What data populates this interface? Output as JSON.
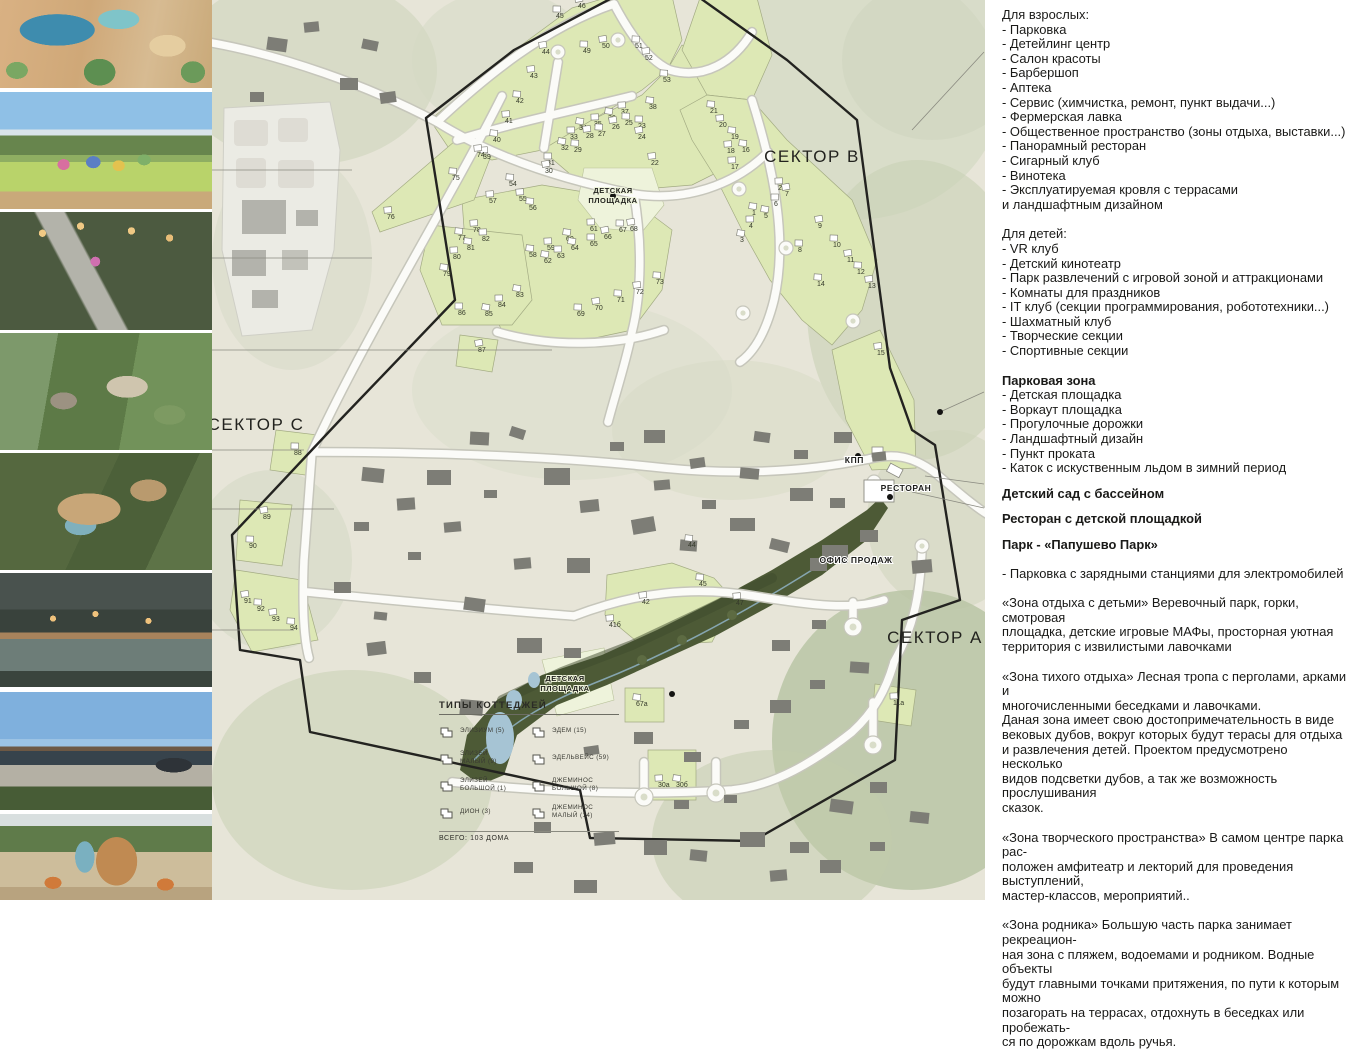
{
  "photos": [
    {
      "name": "waterpark-aerial-render"
    },
    {
      "name": "playground-render"
    },
    {
      "name": "evening-park-stairs-render"
    },
    {
      "name": "park-slope-amphitheatre-render"
    },
    {
      "name": "wooden-decks-pool-aerial-render"
    },
    {
      "name": "pond-bridge-dusk-render"
    },
    {
      "name": "papushevo-park-building-render"
    },
    {
      "name": "play-tower-slide-render"
    }
  ],
  "map": {
    "sector_labels": [
      {
        "text": "СЕКТОР B",
        "x": 600,
        "y": 162
      },
      {
        "text": "СЕКТОР C",
        "x": 44,
        "y": 430
      },
      {
        "text": "СЕКТОР A",
        "x": 723,
        "y": 643
      }
    ],
    "facility_labels": [
      {
        "text": "КПП",
        "x": 652,
        "y": 463,
        "anchor": "end"
      },
      {
        "text": "РЕСТОРАН",
        "x": 694,
        "y": 491,
        "anchor": "middle"
      },
      {
        "text": "ОФИС ПРОДАЖ",
        "x": 644,
        "y": 563,
        "anchor": "middle"
      }
    ],
    "playground_labels": [
      {
        "lines": [
          "ДЕТСКАЯ",
          "ПЛОЩАДКА"
        ],
        "x": 401,
        "y": 193
      },
      {
        "lines": [
          "ДЕТСКАЯ",
          "ПЛОЩАДКА"
        ],
        "x": 353,
        "y": 681
      }
    ],
    "dots": [
      [
        401,
        196
      ],
      [
        460,
        694
      ],
      [
        728,
        412
      ],
      [
        646,
        456
      ],
      [
        678,
        497
      ]
    ],
    "lots": [
      {
        "n": "46",
        "x": 366,
        "y": 8
      },
      {
        "n": "45",
        "x": 344,
        "y": 18
      },
      {
        "n": "44",
        "x": 330,
        "y": 54
      },
      {
        "n": "49",
        "x": 371,
        "y": 53
      },
      {
        "n": "50",
        "x": 390,
        "y": 48
      },
      {
        "n": "51",
        "x": 423,
        "y": 48
      },
      {
        "n": "52",
        "x": 433,
        "y": 60
      },
      {
        "n": "53",
        "x": 451,
        "y": 82
      },
      {
        "n": "43",
        "x": 318,
        "y": 78
      },
      {
        "n": "42",
        "x": 304,
        "y": 103
      },
      {
        "n": "41",
        "x": 293,
        "y": 123
      },
      {
        "n": "40",
        "x": 281,
        "y": 142
      },
      {
        "n": "39",
        "x": 271,
        "y": 159
      },
      {
        "n": "38",
        "x": 437,
        "y": 109
      },
      {
        "n": "37",
        "x": 409,
        "y": 114
      },
      {
        "n": "36",
        "x": 396,
        "y": 120
      },
      {
        "n": "35",
        "x": 382,
        "y": 126
      },
      {
        "n": "34",
        "x": 367,
        "y": 130
      },
      {
        "n": "33",
        "x": 358,
        "y": 139
      },
      {
        "n": "32",
        "x": 349,
        "y": 150
      },
      {
        "n": "31",
        "x": 335,
        "y": 165
      },
      {
        "n": "30",
        "x": 333,
        "y": 173
      },
      {
        "n": "23",
        "x": 426,
        "y": 128
      },
      {
        "n": "24",
        "x": 426,
        "y": 139
      },
      {
        "n": "25",
        "x": 413,
        "y": 125
      },
      {
        "n": "26",
        "x": 400,
        "y": 129
      },
      {
        "n": "27",
        "x": 386,
        "y": 136
      },
      {
        "n": "28",
        "x": 374,
        "y": 138
      },
      {
        "n": "29",
        "x": 362,
        "y": 152
      },
      {
        "n": "22",
        "x": 439,
        "y": 165
      },
      {
        "n": "21",
        "x": 498,
        "y": 113
      },
      {
        "n": "20",
        "x": 507,
        "y": 127
      },
      {
        "n": "19",
        "x": 519,
        "y": 139
      },
      {
        "n": "18",
        "x": 515,
        "y": 153
      },
      {
        "n": "16",
        "x": 530,
        "y": 152
      },
      {
        "n": "17",
        "x": 519,
        "y": 169
      },
      {
        "n": "1",
        "x": 540,
        "y": 215
      },
      {
        "n": "2",
        "x": 566,
        "y": 190
      },
      {
        "n": "3",
        "x": 528,
        "y": 242
      },
      {
        "n": "4",
        "x": 537,
        "y": 228
      },
      {
        "n": "5",
        "x": 552,
        "y": 218
      },
      {
        "n": "6",
        "x": 562,
        "y": 206
      },
      {
        "n": "7",
        "x": 573,
        "y": 196
      },
      {
        "n": "8",
        "x": 586,
        "y": 252
      },
      {
        "n": "9",
        "x": 606,
        "y": 228
      },
      {
        "n": "10",
        "x": 621,
        "y": 247
      },
      {
        "n": "11",
        "x": 635,
        "y": 262
      },
      {
        "n": "12",
        "x": 645,
        "y": 274
      },
      {
        "n": "13",
        "x": 656,
        "y": 288
      },
      {
        "n": "14",
        "x": 605,
        "y": 286
      },
      {
        "n": "15",
        "x": 665,
        "y": 355
      },
      {
        "n": "54",
        "x": 297,
        "y": 186
      },
      {
        "n": "55",
        "x": 307,
        "y": 201
      },
      {
        "n": "56",
        "x": 317,
        "y": 210
      },
      {
        "n": "57",
        "x": 277,
        "y": 203
      },
      {
        "n": "58",
        "x": 317,
        "y": 257
      },
      {
        "n": "59",
        "x": 335,
        "y": 250
      },
      {
        "n": "60",
        "x": 354,
        "y": 241
      },
      {
        "n": "61",
        "x": 378,
        "y": 231
      },
      {
        "n": "62",
        "x": 332,
        "y": 263
      },
      {
        "n": "63",
        "x": 345,
        "y": 258
      },
      {
        "n": "64",
        "x": 359,
        "y": 250
      },
      {
        "n": "65",
        "x": 378,
        "y": 246
      },
      {
        "n": "66",
        "x": 392,
        "y": 239
      },
      {
        "n": "67",
        "x": 407,
        "y": 232
      },
      {
        "n": "68",
        "x": 418,
        "y": 231
      },
      {
        "n": "69",
        "x": 365,
        "y": 316
      },
      {
        "n": "70",
        "x": 383,
        "y": 310
      },
      {
        "n": "71",
        "x": 405,
        "y": 302
      },
      {
        "n": "72",
        "x": 424,
        "y": 294
      },
      {
        "n": "73",
        "x": 444,
        "y": 284
      },
      {
        "n": "74",
        "x": 265,
        "y": 157
      },
      {
        "n": "75",
        "x": 240,
        "y": 180
      },
      {
        "n": "76",
        "x": 175,
        "y": 219
      },
      {
        "n": "77",
        "x": 246,
        "y": 240
      },
      {
        "n": "78",
        "x": 261,
        "y": 232
      },
      {
        "n": "79",
        "x": 231,
        "y": 276
      },
      {
        "n": "80",
        "x": 241,
        "y": 259
      },
      {
        "n": "81",
        "x": 255,
        "y": 250
      },
      {
        "n": "82",
        "x": 270,
        "y": 241
      },
      {
        "n": "83",
        "x": 304,
        "y": 297
      },
      {
        "n": "84",
        "x": 286,
        "y": 307
      },
      {
        "n": "85",
        "x": 273,
        "y": 316
      },
      {
        "n": "86",
        "x": 246,
        "y": 315
      },
      {
        "n": "87",
        "x": 266,
        "y": 352
      },
      {
        "n": "88",
        "x": 82,
        "y": 455
      },
      {
        "n": "89",
        "x": 51,
        "y": 519
      },
      {
        "n": "90",
        "x": 37,
        "y": 548
      },
      {
        "n": "91",
        "x": 32,
        "y": 603
      },
      {
        "n": "92",
        "x": 45,
        "y": 611
      },
      {
        "n": "93",
        "x": 60,
        "y": 621
      },
      {
        "n": "94",
        "x": 78,
        "y": 630
      },
      {
        "n": "42",
        "x": 430,
        "y": 604
      },
      {
        "n": "45",
        "x": 487,
        "y": 586
      },
      {
        "n": "47",
        "x": 524,
        "y": 605
      },
      {
        "n": "44",
        "x": 476,
        "y": 547
      },
      {
        "n": "41б",
        "x": 397,
        "y": 627
      },
      {
        "n": "67а",
        "x": 424,
        "y": 706
      },
      {
        "n": "30а",
        "x": 446,
        "y": 787
      },
      {
        "n": "30б",
        "x": 464,
        "y": 787
      },
      {
        "n": "11а",
        "x": 681,
        "y": 705
      }
    ],
    "legend": {
      "title": "ТИПЫ КОТТЕДЖЕЙ",
      "total": "ВСЕГО: 103 ДОМА",
      "col1": [
        "ЭЛИЗИУМ (5)",
        "ЭЛИЗЕЙ\nМАЛЫЙ (9)",
        "ЭЛИЗЕЙ\nБОЛЬШОЙ (1)",
        "ДИОН (3)"
      ],
      "col2": [
        "ЭДЕМ (15)",
        "ЭДЕЛЬВЕЙС (59)",
        "ДЖЕМИНОС\nБОЛЬШОЙ (8)",
        "ДЖЕМИНОС\nМАЛЫЙ (14)"
      ]
    }
  },
  "panel": {
    "adults_title": "Для взрослых:",
    "adults": [
      "Парковка",
      "Детейлинг центр",
      "Салон красоты",
      "Барбершоп",
      "Аптека",
      "Сервис (химчистка, ремонт, пункт выдачи...)",
      "Фермерская лавка",
      "Общественное пространство (зоны отдыха, выставки...)",
      "Панорамный ресторан",
      "Сигарный клуб",
      "Винотека",
      "Эксплуатируемая кровля с террасами\n и ландшафтным дизайном"
    ],
    "kids_title": "Для детей:",
    "kids": [
      "VR клуб",
      "Детский кинотеатр",
      "Парк развлечений с игровой зоной и аттракционами",
      "Комнаты для праздников",
      "IT клуб (секции программирования, робототехники...)",
      "Шахматный клуб",
      "Творческие секции",
      "Спортивные секции"
    ],
    "park_title": "Парковая зона",
    "park": [
      "Детская площадка",
      "Воркаут площадка",
      "Прогулочные дорожки",
      "Ландшафтный дизайн",
      "Пункт проката",
      "Каток с искуственным льдом в зимний период"
    ],
    "heading_kindergarten": "Детский сад с бассейном",
    "heading_restaurant": "Ресторан с детской площадкой",
    "heading_park": "Парк - «Папушево Парк»",
    "parking_line": "- Парковка с зарядными станциями для электромобилей",
    "paragraphs": [
      "«Зона отдыха с детьми» Веревочный парк, горки, смотровая\nплощадка, детские игровые МАФы, просторная уютная\nтерритория с извилистыми лавочками",
      "«Зона тихого отдыха» Лесная тропа с перголами, арками и\nмногочисленными беседками и лавочками.\nДаная зона имеет свою достопримечательность в виде\nвековых дубов, вокруг которых будут терасы для отдыха\nи развлечения детей. Проектом предусмотрено несколько\nвидов подсветки дубов, а так же возможность прослушивания\nсказок.",
      "«Зона творческого пространства» В самом центре парка рас-\nположен амфитеатр и лекторий для проведения выступлений,\nмастер-классов, мероприятий..",
      "«Зона родника» Большую часть парка занимает рекреацион-\nная зона с пляжем, водоемами и родником. Водные объекты\nбудут главными точками притяжения, по пути к которым можно\nпозагорать  на террасах, отдохнуть в беседках или пробежать-\nся по дорожкам вдоль ручья."
    ]
  },
  "colors": {
    "background": "#e7e5d8",
    "lot_green": "#dde8b5",
    "park_green": "#4d5a36",
    "pond_blue": "#a6c4d4",
    "boundary": "#232320"
  }
}
